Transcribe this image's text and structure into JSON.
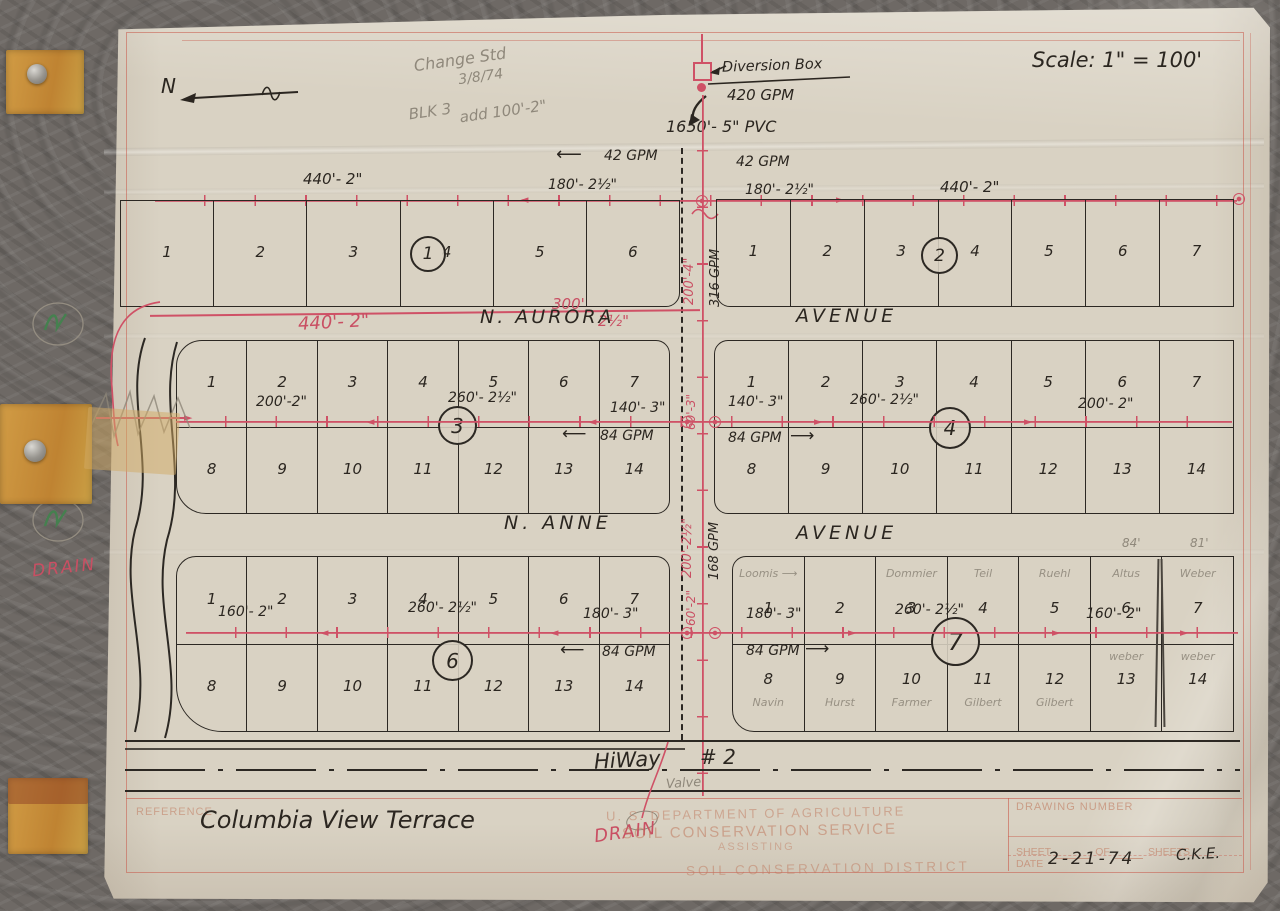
{
  "header": {
    "scale": "Scale: 1\" = 100'",
    "north": "N"
  },
  "change_note": {
    "line1": "Change Std",
    "line2": "3/8/74",
    "line3": "BLK 3",
    "line4": "add 100'-2\""
  },
  "diversion": {
    "label": "Diversion Box",
    "flow": "420 GPM",
    "pvc": "1650'- 5\" PVC"
  },
  "flows": {
    "top_left": "42 GPM",
    "top_right": "42 GPM",
    "b3": "84 GPM",
    "b4": "84 GPM",
    "b6": "84 GPM",
    "b7": "84 GPM"
  },
  "mainline": {
    "seg1": "200'-4\"",
    "seg1_flow": "316 GPM",
    "seg2": "60'-3\"",
    "seg3": "200'-2½\"",
    "seg3_flow": "168 GPM",
    "seg4": "60'-2\""
  },
  "dims": {
    "b1_main": "440'- 2\"",
    "b1_lat": "180'- 2½\"",
    "b2_lat": "180'- 2½\"",
    "b2_main": "440'- 2\"",
    "aurora_main": "440'- 2\"",
    "aurora_len": "300'",
    "aurora_size": "2½\"",
    "b3_1": "200'-2\"",
    "b3_2": "260'- 2½\"",
    "b3_3": "140'- 3\"",
    "b4_1": "140'- 3\"",
    "b4_2": "260'- 2½\"",
    "b4_3": "200'- 2\"",
    "b6_1": "160'-  2\"",
    "b6_2": "260'- 2½\"",
    "b6_3": "180'- 3\"",
    "b7_1": "180'- 3\"",
    "b7_2": "260'- 2½\"",
    "b7_3": "160'- 2\"",
    "lot6_width": "84'",
    "lot7_width": "81'"
  },
  "streets": {
    "aurora": "N. AURORA",
    "aurora_avenue": "AVENUE",
    "anne": "N. ANNE",
    "anne_avenue": "AVENUE"
  },
  "highway": {
    "name": "HiWay",
    "number": "# 2",
    "valve": "Valve"
  },
  "drain": {
    "left": "DRAIN",
    "bottom": "DRAIN"
  },
  "blocks": [
    {
      "id": "1",
      "label": "1",
      "lots_top": [
        "1",
        "2",
        "3",
        "4",
        "5",
        "6"
      ]
    },
    {
      "id": "2",
      "label": "2",
      "lots_top": [
        "1",
        "2",
        "3",
        "4",
        "5",
        "6",
        "7"
      ]
    },
    {
      "id": "3",
      "label": "3",
      "lots_top": [
        "1",
        "2",
        "3",
        "4",
        "5",
        "6",
        "7"
      ],
      "lots_bottom": [
        "8",
        "9",
        "10",
        "11",
        "12",
        "13",
        "14"
      ]
    },
    {
      "id": "4",
      "label": "4",
      "lots_top": [
        "1",
        "2",
        "3",
        "4",
        "5",
        "6",
        "7"
      ],
      "lots_bottom": [
        "8",
        "9",
        "10",
        "11",
        "12",
        "13",
        "14"
      ]
    },
    {
      "id": "6",
      "label": "6",
      "lots_top": [
        "1",
        "2",
        "3",
        "4",
        "5",
        "6",
        "7"
      ],
      "lots_bottom": [
        "8",
        "9",
        "10",
        "11",
        "12",
        "13",
        "14"
      ]
    },
    {
      "id": "7",
      "label": "7",
      "lots_top": [
        "1",
        "2",
        "3",
        "4",
        "5",
        "6",
        "7"
      ],
      "lots_bottom": [
        "8",
        "9",
        "10",
        "11",
        "12",
        "13",
        "14"
      ],
      "owners_top": [
        "Loomis ⟶",
        "",
        "Dommier",
        "Teil",
        "Ruehl",
        "Altus",
        "Weber"
      ],
      "owners_bottom": [
        "Navin",
        "Hurst",
        "Farmer",
        "Gilbert",
        "Gilbert",
        "weber",
        "weber"
      ]
    }
  ],
  "stamps": {
    "usda": "U. S. DEPARTMENT OF AGRICULTURE",
    "scs": "SOIL CONSERVATION SERVICE",
    "assisting": "ASSISTING",
    "district": "SOIL CONSERVATION DISTRICT"
  },
  "title_block": {
    "reference": "REFERENCE",
    "title": "Columbia View Terrace",
    "drawing_number": "DRAWING NUMBER",
    "sheet": "SHEET",
    "of": "OF",
    "sheets": "SHEETS",
    "date_label": "DATE",
    "date": "2-21-74",
    "initials": "C.K.E."
  }
}
